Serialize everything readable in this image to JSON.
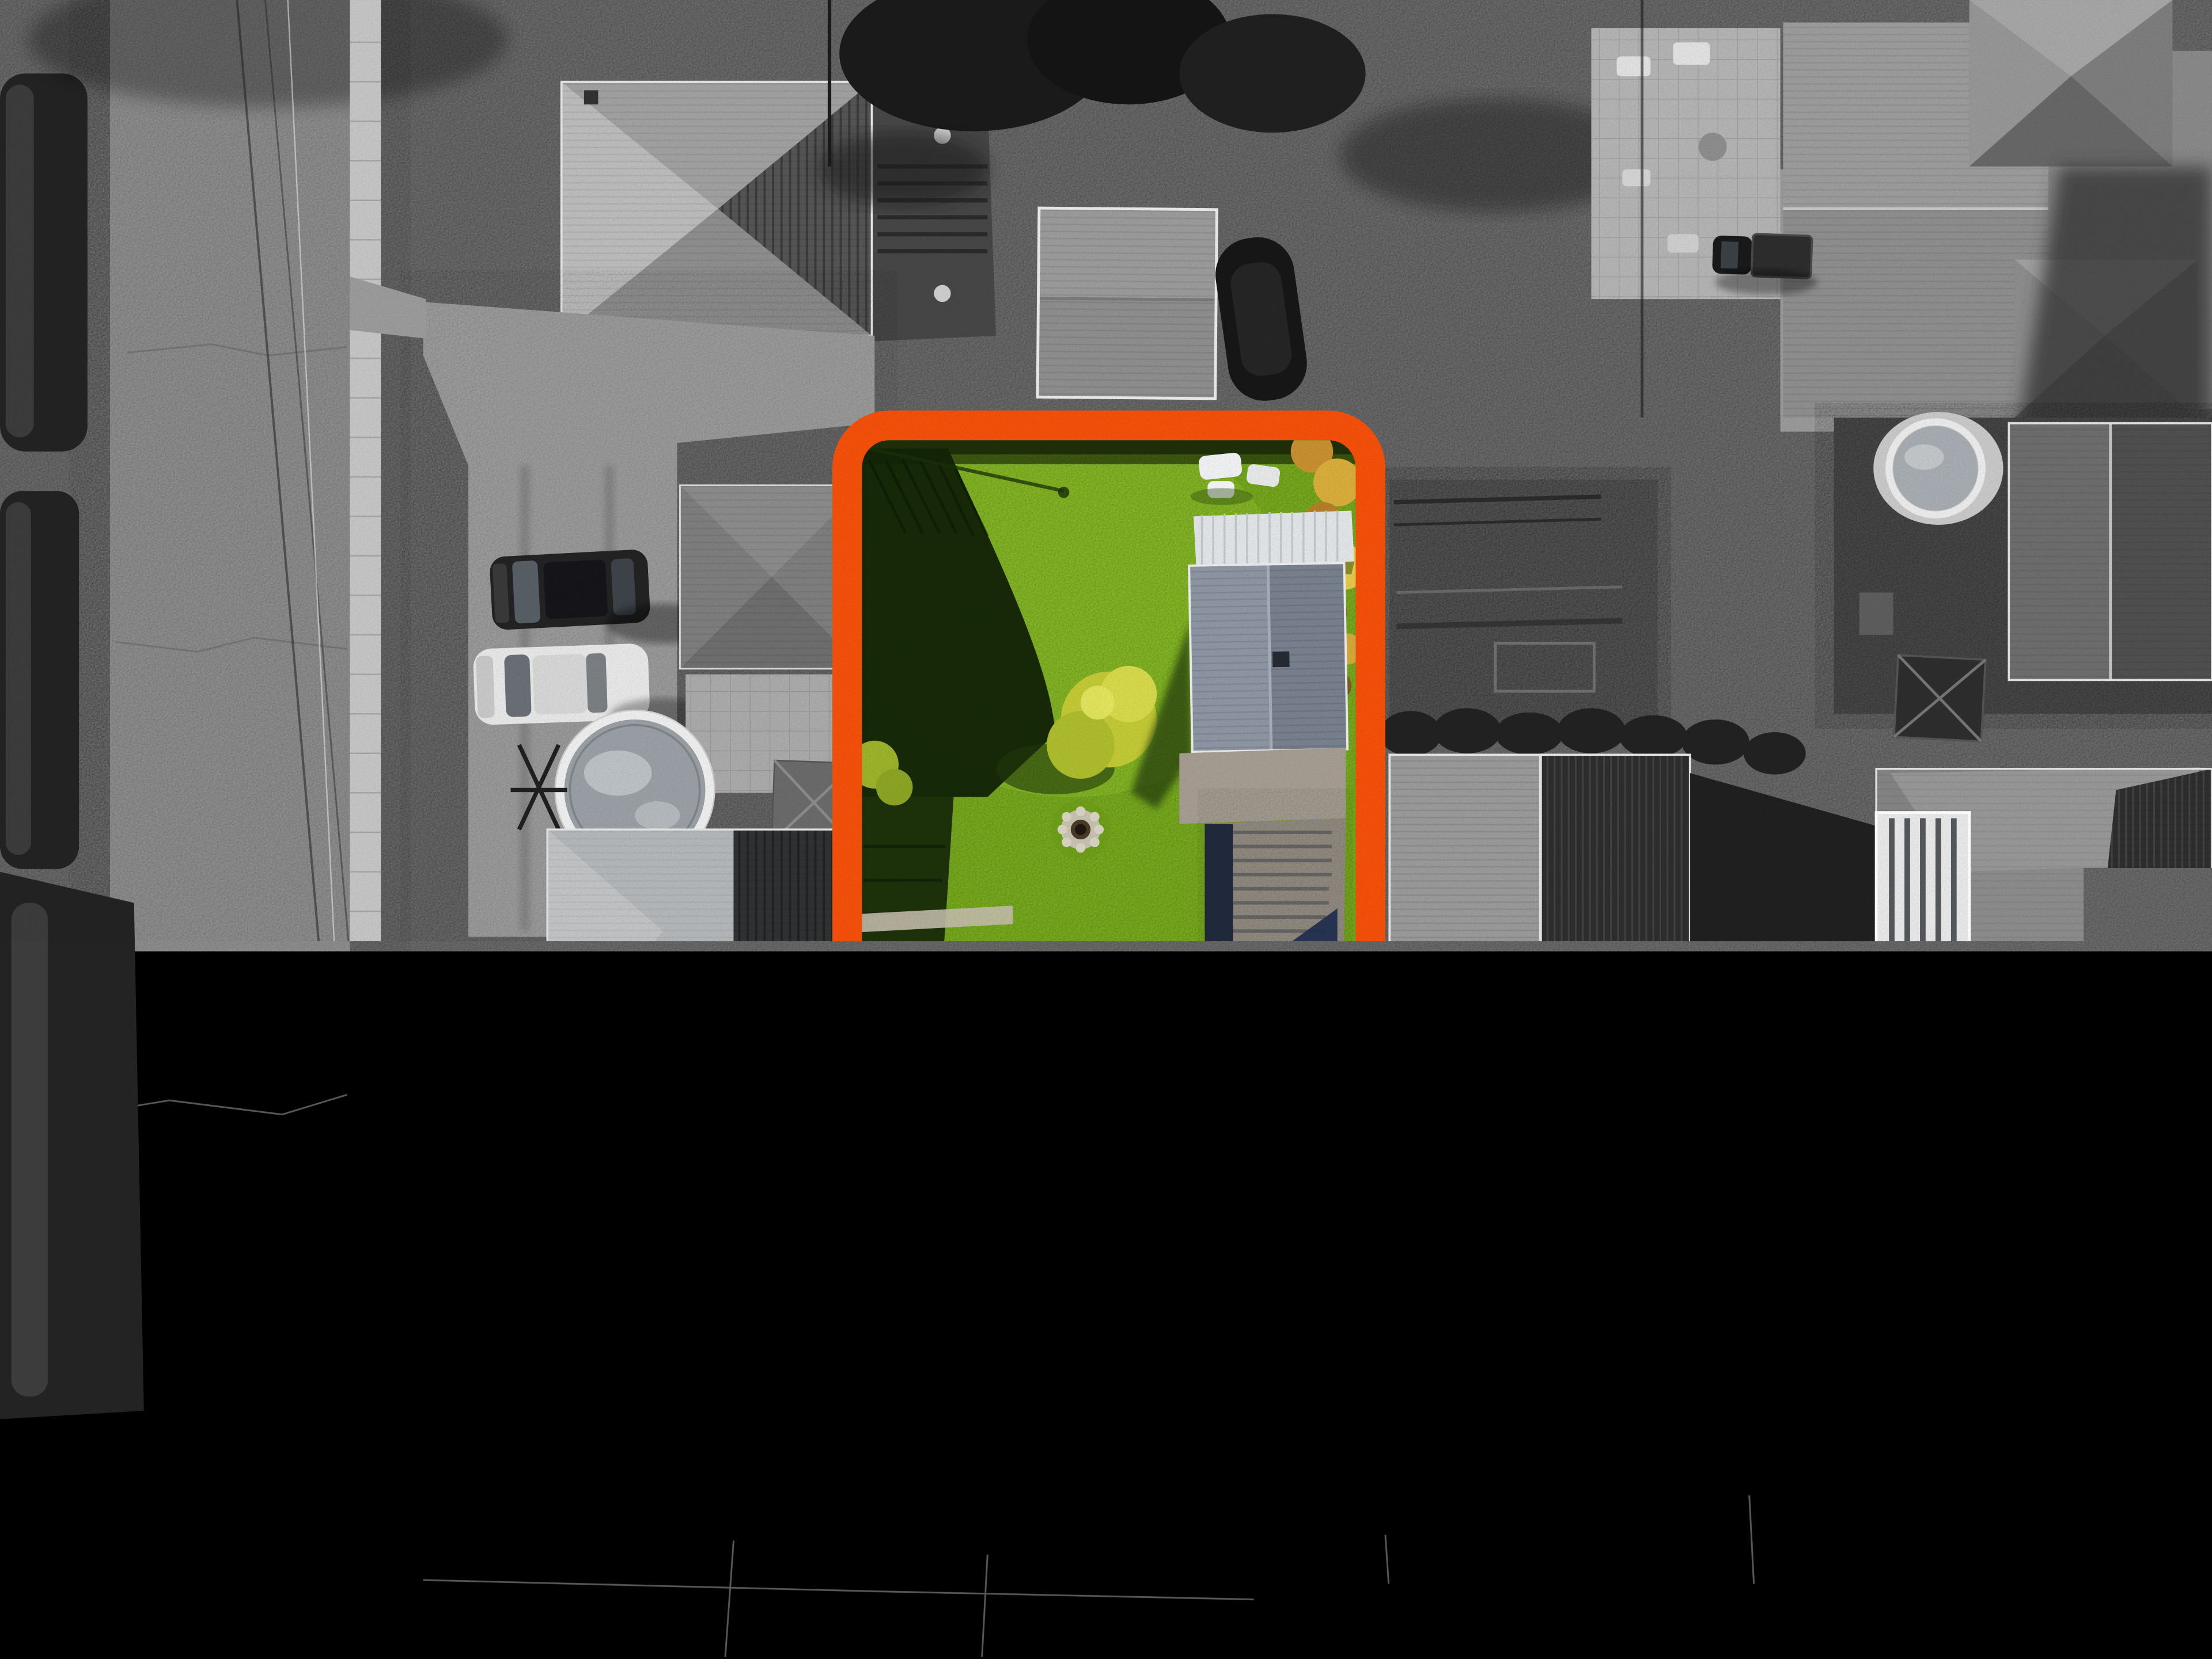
{
  "scene": {
    "type": "aerial-drone-photograph",
    "style": "selective-color real-estate lot highlight",
    "description": "Top-down aerial photo of a suburban residential block. The whole neighborhood is desaturated grayscale except one subject lot, which is shown in full color (bright green lawn) and outlined with a thick orange rounded-rectangle property boundary.",
    "highlighted_lot": {
      "outline_shape": "rounded-rectangle",
      "features": [
        "board fence with shadow along left boundary",
        "bright green backyard lawn",
        "stone fire pit ring",
        "yellow-green ornamental tree",
        "white patio furniture set",
        "autumn orange shrubs along top-right",
        "white ribbed carport awning",
        "detached garage with gray shingle gable roof",
        "concrete pad and long driveway with deep blue house shadow",
        "gray hip-roof house with dark shingle wing and two chimneys",
        "front concrete walkway to sidewalk",
        "mature tree in front yard"
      ]
    },
    "surroundings": [
      "vertical street on the left with utility lines and a parked dark car",
      "horizontal street along the bottom with sidewalk and grass verge",
      "white painted stop bars at the intersection",
      "upper-left corner house with hip roof and wooden deck",
      "left neighbor with driveway, dark SUV, white sedan, detached garage, round above-ground pool and large hip-roof house",
      "gray shed and covered boat above the subject lot",
      "large top-right house with paver patio, parked pickup truck and pyramid roof wings",
      "right-rear yard with round pool, big gable garage and gazebo",
      "right neighbor gable-roof house with half-lit half-shadow slopes and shadowed driveway",
      "far-right hip-roof house with white sunroom and rock garden",
      "utility pole shadows across the roads"
    ]
  },
  "colors": {
    "accent_orange": "#F4510A",
    "lawn_green": "#7AAE1E",
    "lawn_light": "#8FC42C",
    "lawn_shadow": "#132407",
    "tree_yellow": "#C3CA36",
    "autumn_bush": "#D9AE3C",
    "subject_roof_light": "#B2B7BF",
    "subject_roof_dark": "#3B4759",
    "garage_roof": "#8E97A4",
    "carport_white": "#E3E6E8",
    "driveway_concrete": "#948D83",
    "shadow_navy": "#1F2E4E",
    "road_gray": "#8E8E8E",
    "sidewalk_gray": "#C6C6C6",
    "verge_gray": "#4C4C4C",
    "grass_gray": "#6B6B6B",
    "hedge_dark": "#232323",
    "roof_light_gray": "#B3B3B3",
    "roof_dark_gray": "#2E2E2E",
    "white_vehicle": "#E8E8E8",
    "dark_vehicle": "#1D1D1D",
    "firepit_stone": "#C8C2B2"
  }
}
